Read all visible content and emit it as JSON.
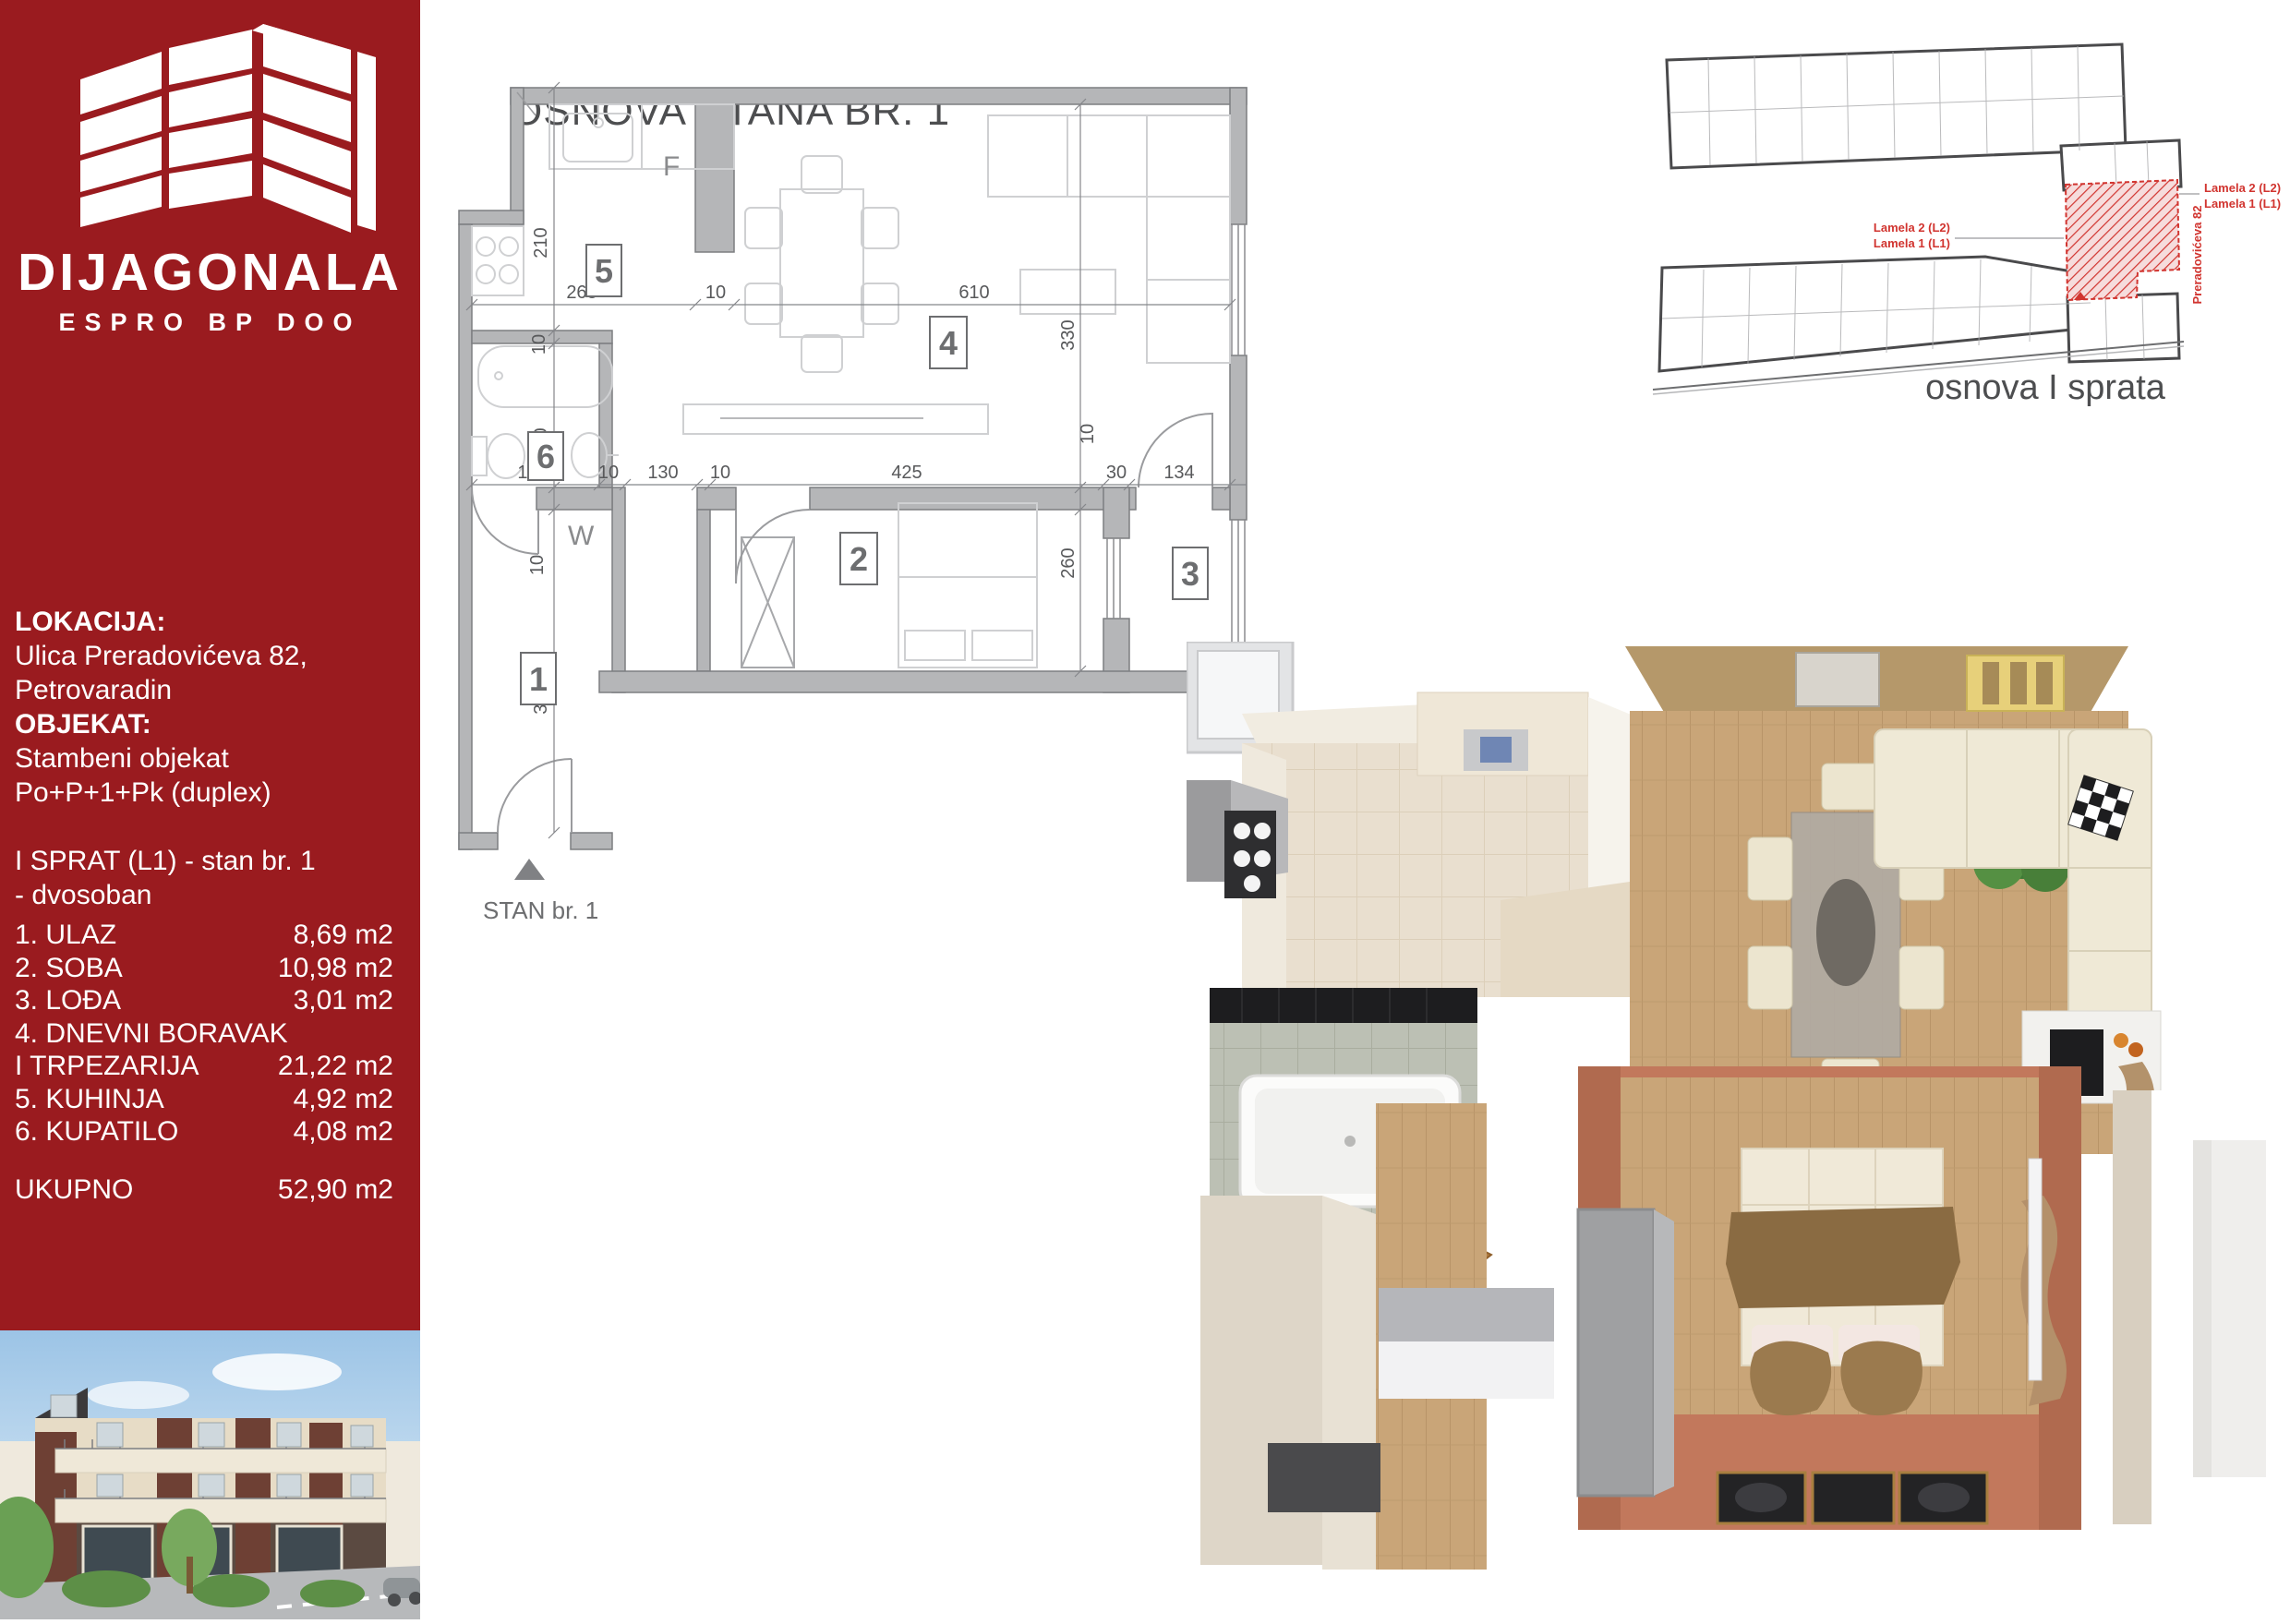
{
  "colors": {
    "sidebar_red": "#9a1b1f",
    "accent_red": "#d1342f",
    "title_gray": "#4d4e50",
    "wall_gray": "#b5b6b8",
    "dim_gray": "#58595b",
    "wood": "#c9a578",
    "salmon": "#c2785c",
    "cream": "#ece5cf"
  },
  "sidebar": {
    "brand": "DIJAGONALA",
    "brand_sub": "ESPRO BP DOO",
    "location_label": "LOKACIJA:",
    "location_line1": "Ulica Preradovićeva 82,",
    "location_line2": "Petrovaradin",
    "object_label": "OBJEKAT:",
    "object_line1": "Stambeni objekat",
    "object_line2": "Po+P+1+Pk (duplex)",
    "unit_line1": "I SPRAT (L1) - stan br. 1",
    "unit_line2": "- dvosoban",
    "rooms": [
      {
        "name": "1. ULAZ",
        "area": "8,69 m2"
      },
      {
        "name": "2. SOBA",
        "area": "10,98 m2"
      },
      {
        "name": "3. LOĐA",
        "area": "3,01 m2"
      },
      {
        "name": "4. DNEVNI BORAVAK",
        "area": ""
      },
      {
        "name": "I TRPEZARIJA",
        "area": "21,22 m2"
      },
      {
        "name": "5. KUHINJA",
        "area": "4,92 m2"
      },
      {
        "name": "6. KUPATILO",
        "area": "4,08 m2"
      }
    ],
    "total_label": "UKUPNO",
    "total_area": "52,90 m2"
  },
  "floorplan": {
    "title": "OSNOVA STANA BR. 1",
    "unit_marker": "STAN br. 1",
    "rooms": {
      "r1": "1",
      "r2": "2",
      "r3": "3",
      "r4": "4",
      "r5": "5",
      "r6": "6"
    },
    "labels": {
      "fridge": "F",
      "washer": "W"
    },
    "dims": {
      "d263": "263",
      "d10a": "10",
      "d610": "610",
      "d210": "210",
      "d10b": "10",
      "d240": "240",
      "d10c": "10",
      "d319": "319",
      "d170": "170",
      "d10d": "10",
      "d130": "130",
      "d10e": "10",
      "d425": "425",
      "d30": "30",
      "d134": "134",
      "d330": "330",
      "d10f": "10",
      "d260": "260"
    }
  },
  "overview": {
    "caption": "osnova I sprata",
    "lamela2": "Lamela 2 (L2)",
    "lamela1": "Lamela 1 (L1)",
    "street": "Preradovićeva 82"
  }
}
